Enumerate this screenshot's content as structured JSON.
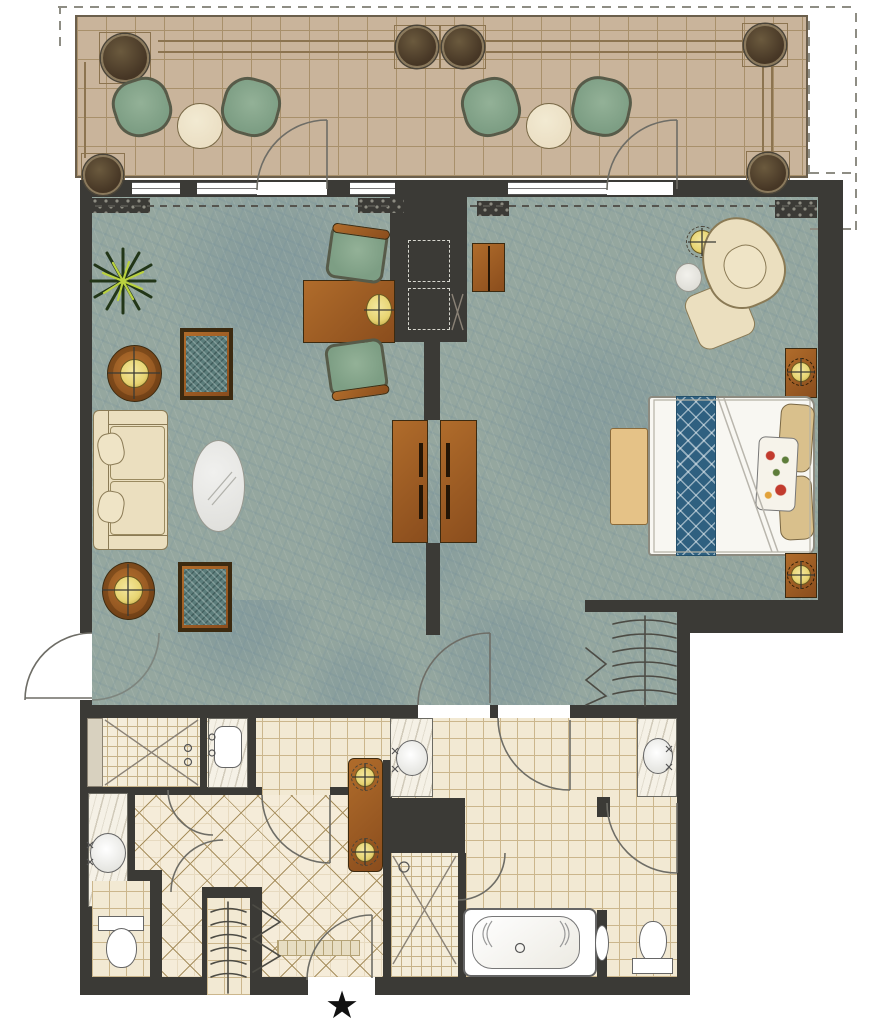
{
  "document": {
    "kind": "hotel suite floor plan",
    "visible_text": "none (graphic plan only)"
  },
  "entry": {
    "star_glyph": "★"
  },
  "palette": {
    "wall": "#3b3a36",
    "outside": "#ffffff",
    "balconyFloor": "#c9b49b",
    "balconyLine": "#a8906b",
    "balconyTrim": "#8c7450",
    "planter": "#463625",
    "planterRing": "#8a795c",
    "chairGreen": "#7d9e84",
    "chairFrame": "#575b49",
    "tableCream": "#ebdfc4",
    "carpet": "#95a79f",
    "carpetVein": "#6f8d99",
    "wood": "#8a4d1d",
    "woodLight": "#b06c2b",
    "sofaCream": "#ebdfbf",
    "outlineTan": "#8a7a55",
    "cushionTeal": "#5c7d7b",
    "tableGrey": "#e8e8e4",
    "bedWhite": "#f8f7f2",
    "runnerBlue": "#2f6080",
    "pillowTan": "#d9c08c",
    "benchTan": "#e5c287",
    "lampGold": "#e7d472",
    "tile": "#f2e9d3",
    "tileLine": "#cbb68c",
    "diamondLine": "#a8905f",
    "marble": "#f5f1e6",
    "fixtureLine": "#666660",
    "arcLine": "#6e6d66",
    "star": "#111111"
  },
  "rooms": {
    "terrace": {
      "items": [
        "bistro chair × 4",
        "round side table × 2",
        "planter urn × 6",
        "terrace door × 2",
        "decorative trellis border"
      ]
    },
    "living_room": {
      "items": [
        "sofa with pillows",
        "oval coffee table",
        "club chair × 2",
        "round lamp table × 2",
        "table lamp × 2",
        "writing desk",
        "desk lamp",
        "desk chair × 2",
        "potted plant",
        "media cabinet",
        "fireplace niche"
      ]
    },
    "bedroom": {
      "items": [
        "king bed",
        "diamond bed runner",
        "tan pillows × 2",
        "floral pillow",
        "nightstand with lamp × 2",
        "foot bench",
        "wingback chair",
        "ottoman",
        "drink table",
        "floor lamp",
        "minibar cabinet",
        "media cabinet",
        "wardrobe closet with hangers"
      ]
    },
    "master_bathroom": {
      "items": [
        "vanity sink × 2",
        "soaking tub with faucet",
        "walk-in shower",
        "water closet with toilet"
      ]
    },
    "guest_bathroom": {
      "items": [
        "shower with bench",
        "sink counter",
        "vanity sink",
        "toilet compartment"
      ]
    },
    "hallway": {
      "items": [
        "console table with two lamps",
        "linen closet with hangers",
        "bifold closet",
        "diamond tile floor"
      ]
    },
    "entry_notes": {
      "items": [
        "entry door with swing",
        "star entrance marker",
        "connecting door on west wall"
      ]
    }
  }
}
